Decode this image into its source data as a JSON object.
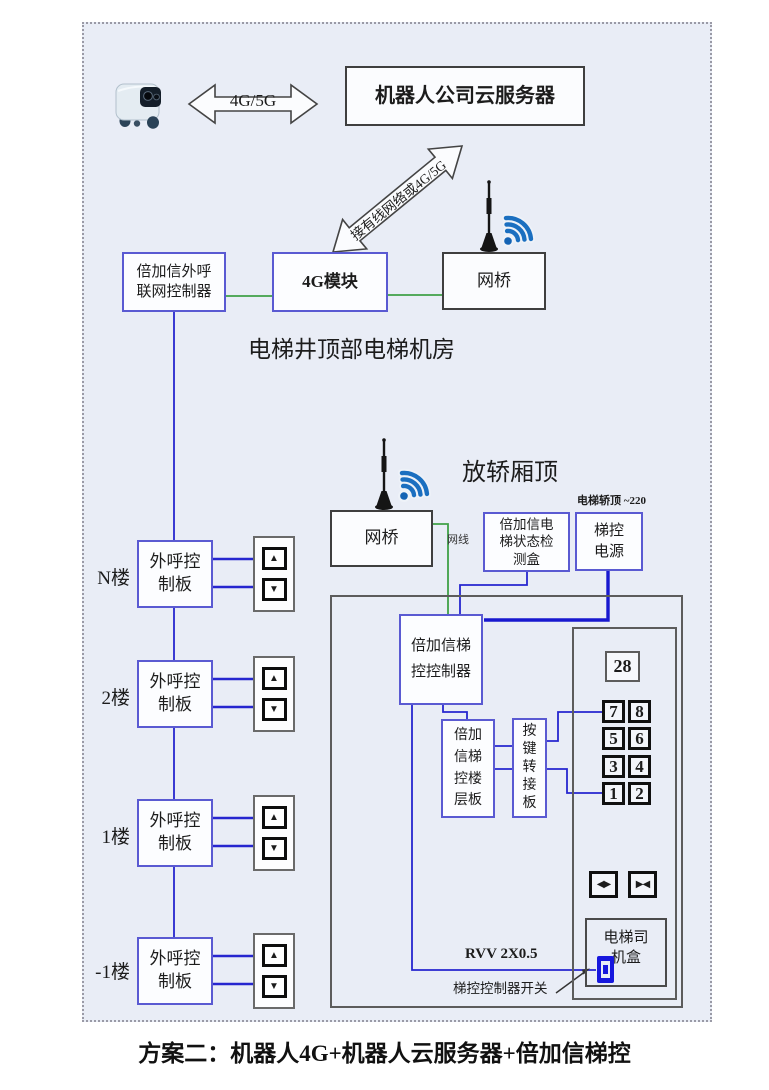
{
  "top": {
    "link_label": "4G/5G",
    "cloud_server": "机器人公司云服务器",
    "uplink_label": "接有线网络或4G/5G"
  },
  "machine_room": {
    "controller_lines": [
      "倍加信外呼",
      "联网控制器"
    ],
    "module_4g": "4G模块",
    "bridge": "网桥",
    "caption": "电梯井顶部电梯机房"
  },
  "car_top": {
    "caption": "放轿厢顶",
    "bridge": "网桥",
    "cable_label": "网线",
    "status_lines": [
      "倍加信电",
      "梯状态检",
      "测盒"
    ],
    "power_note": "电梯轿顶 ~220",
    "power_lines": [
      "梯控",
      "电源"
    ]
  },
  "control": {
    "main_lines": [
      "倍加信梯",
      "控控制器"
    ],
    "floor_board_lines": [
      "倍加",
      "信梯",
      "控楼",
      "层板"
    ],
    "key_adapter_chars": [
      "按",
      "键",
      "转",
      "接",
      "板"
    ]
  },
  "cop": {
    "display": "28",
    "buttons": [
      "7",
      "8",
      "5",
      "6",
      "3",
      "4",
      "1",
      "2"
    ],
    "door_open_glyph": "◀▶",
    "door_close_glyph": "▶◀",
    "driver_lines": [
      "电梯司",
      "机盒"
    ]
  },
  "wiring": {
    "rvv_label": "RVV 2X0.5",
    "switch_label": "梯控控制器开关"
  },
  "floors": [
    {
      "label": "N楼",
      "box_lines": [
        "外呼控",
        "制板"
      ],
      "up": "▲",
      "down": "▼"
    },
    {
      "label": "2楼",
      "box_lines": [
        "外呼控",
        "制板"
      ],
      "up": "▲",
      "down": "▼"
    },
    {
      "label": "1楼",
      "box_lines": [
        "外呼控",
        "制板"
      ],
      "up": "▲",
      "down": "▼"
    },
    {
      "label": "-1楼",
      "box_lines": [
        "外呼控",
        "制板"
      ],
      "up": "▲",
      "down": "▼"
    }
  ],
  "caption": "方案二：机器人4G+机器人云服务器+倍加信梯控",
  "colors": {
    "accent_box_blue": "#5a5ad2",
    "wire_blue": "#2626cf",
    "wire_green": "#3fa047",
    "wifi_blue": "#1b6fc0",
    "frame_bg": "#e9edf6"
  }
}
